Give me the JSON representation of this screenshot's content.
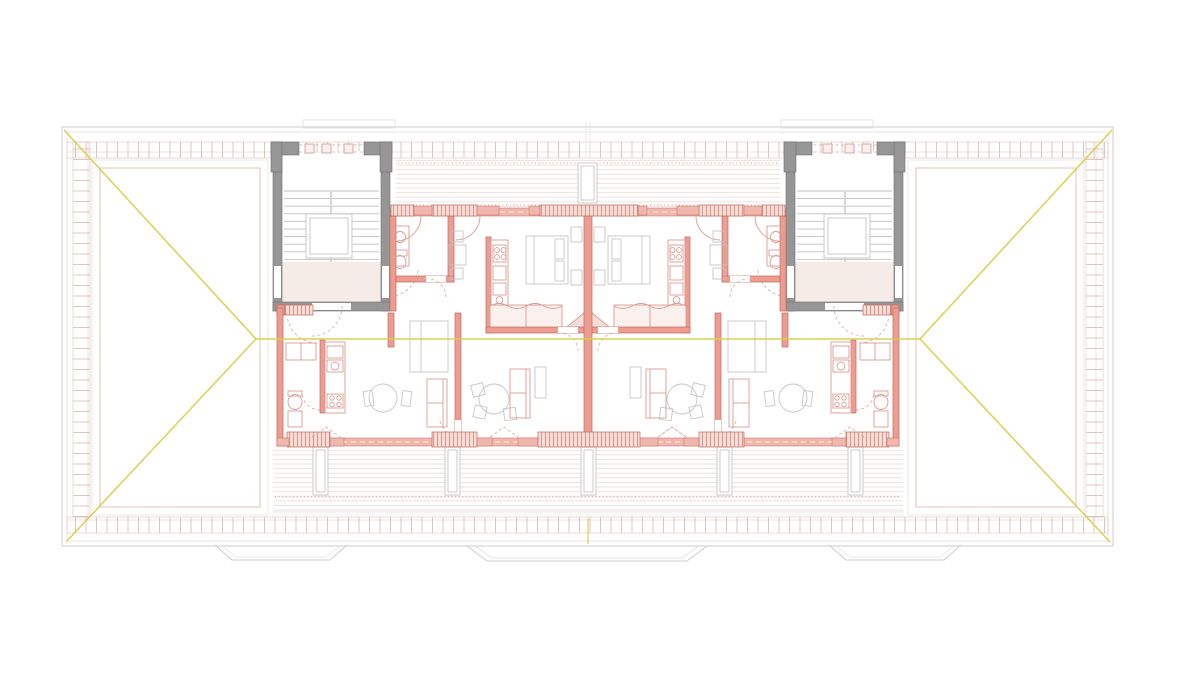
{
  "canvas": {
    "width": 1200,
    "height": 696,
    "background": "#ffffff"
  },
  "drawing": {
    "type": "architectural-floor-plan",
    "content": "attic storey plan: two mirrored stair cores, four dwelling units, hipped roof with yellow ridge lines, upper and lower timber-deck terraces",
    "stair_cores": 2,
    "apartment_units": 4,
    "text_labels": "none"
  },
  "colors": {
    "background": "#ffffff",
    "roof_outline": "#cccccc",
    "roof_outline_light": "#e0e0e0",
    "roof_inset": "#e8e8e8",
    "roof_inset_pink": "#e2bcb4",
    "tile_tick": "#d9b6ad",
    "tile_band_edge": "#dcc4bd",
    "ridge_yellow": "#d9ce4a",
    "core_wall": "#969696",
    "core_wall_edge": "#6f6f6f",
    "stair_line": "#bcbcbc",
    "vestibule_fill": "#f5ebe7",
    "wall_stroke": "#c4685e",
    "wall_fill": "#ec9c91",
    "wall_band_fill": "#f0b7ae",
    "sill_fill": "#f6ddd8",
    "sill_hatch": "#d98f84",
    "furniture_pink": "#dc9c92",
    "furniture_pink_fill": "#faf1ef",
    "furniture_gray": "#c6c6c6",
    "deck_line": "#ead9d4",
    "deck_dot": "#dd9488",
    "door_dash": "#d6a79c",
    "dark_bar": "#8f8f8f"
  }
}
